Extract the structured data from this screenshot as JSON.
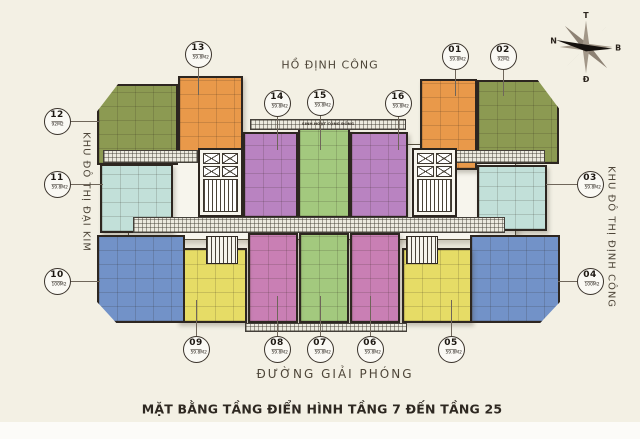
{
  "title": "MẶT BẰNG TẦNG ĐIỂN HÌNH TẦNG 7 ĐẾN TẦNG 25",
  "surroundings": {
    "top": "HỒ ĐỊNH CÔNG",
    "left": "KHU ĐÔ THỊ ĐẠI KIM",
    "right": "KHU ĐÔ THỊ ĐỊNH CÔNG",
    "bottom": "ĐƯỜNG GIẢI PHÓNG"
  },
  "compass": {
    "top": "T",
    "right": "B",
    "bottom": "Đ",
    "left": "N"
  },
  "community_label": "SINH HOẠT CỘNG ĐỒNG",
  "palette": {
    "background": "#f3f0e4",
    "wall": "#2d2620",
    "label_text": "#4e4639",
    "title_text": "#2e2821",
    "orange": "#e9994a",
    "olive": "#8c9a52",
    "teal": "#c2e0d9",
    "blue": "#7292c8",
    "purple": "#b983c1",
    "pink": "#c97fb4",
    "green": "#a3c97e",
    "yellow": "#e6dc66"
  },
  "units": [
    {
      "id": "01",
      "area": "59.8M2",
      "color": "#e9994a",
      "circle": {
        "x": 455,
        "y": 56
      },
      "leader": {
        "x1": 455,
        "y1": 69,
        "x2": 455,
        "y2": 96
      },
      "block": {
        "x": 420,
        "y": 79,
        "w": 57,
        "h": 91,
        "shape": "rect"
      }
    },
    {
      "id": "02",
      "area": "92M2",
      "color": "#8c9a52",
      "circle": {
        "x": 503,
        "y": 56
      },
      "leader": {
        "x1": 503,
        "y1": 69,
        "x2": 503,
        "y2": 96
      },
      "block": {
        "x": 477,
        "y": 80,
        "w": 82,
        "h": 84,
        "shape": "tr-slope"
      }
    },
    {
      "id": "03",
      "area": "59.8M2",
      "color": "#c2e0d9",
      "circle": {
        "x": 590,
        "y": 184
      },
      "leader": {
        "x1": 577,
        "y1": 184,
        "x2": 546,
        "y2": 184
      },
      "block": {
        "x": 477,
        "y": 165,
        "w": 70,
        "h": 66,
        "shape": "rect"
      }
    },
    {
      "id": "04",
      "area": "100M2",
      "color": "#7292c8",
      "circle": {
        "x": 590,
        "y": 281
      },
      "leader": {
        "x1": 577,
        "y1": 281,
        "x2": 558,
        "y2": 281
      },
      "block": {
        "x": 470,
        "y": 235,
        "w": 90,
        "h": 88,
        "shape": "br-slope"
      }
    },
    {
      "id": "05",
      "area": "59.8M2",
      "color": "#e6dc66",
      "circle": {
        "x": 451,
        "y": 349
      },
      "leader": {
        "x1": 451,
        "y1": 300,
        "x2": 451,
        "y2": 336
      },
      "block": {
        "x": 402,
        "y": 248,
        "w": 70,
        "h": 75,
        "shape": "rect"
      }
    },
    {
      "id": "06",
      "area": "59.8M2",
      "color": "#c97fb4",
      "circle": {
        "x": 370,
        "y": 349
      },
      "leader": {
        "x1": 370,
        "y1": 296,
        "x2": 370,
        "y2": 336
      },
      "block": {
        "x": 350,
        "y": 233,
        "w": 50,
        "h": 90,
        "shape": "rect"
      }
    },
    {
      "id": "07",
      "area": "59.8M2",
      "color": "#a3c97e",
      "circle": {
        "x": 320,
        "y": 349
      },
      "leader": {
        "x1": 320,
        "y1": 296,
        "x2": 320,
        "y2": 336
      },
      "block": {
        "x": 299,
        "y": 233,
        "w": 50,
        "h": 90,
        "shape": "rect"
      }
    },
    {
      "id": "08",
      "area": "59.8M2",
      "color": "#c97fb4",
      "circle": {
        "x": 277,
        "y": 349
      },
      "leader": {
        "x1": 277,
        "y1": 296,
        "x2": 277,
        "y2": 336
      },
      "block": {
        "x": 248,
        "y": 233,
        "w": 50,
        "h": 90,
        "shape": "rect"
      }
    },
    {
      "id": "09",
      "area": "59.8M2",
      "color": "#e6dc66",
      "circle": {
        "x": 196,
        "y": 349
      },
      "leader": {
        "x1": 196,
        "y1": 300,
        "x2": 196,
        "y2": 336
      },
      "block": {
        "x": 177,
        "y": 248,
        "w": 70,
        "h": 75,
        "shape": "rect"
      }
    },
    {
      "id": "10",
      "area": "100M2",
      "color": "#7292c8",
      "circle": {
        "x": 57,
        "y": 281
      },
      "leader": {
        "x1": 70,
        "y1": 281,
        "x2": 100,
        "y2": 281
      },
      "block": {
        "x": 97,
        "y": 235,
        "w": 88,
        "h": 88,
        "shape": "bl-slope"
      }
    },
    {
      "id": "11",
      "area": "59.8M2",
      "color": "#c2e0d9",
      "circle": {
        "x": 57,
        "y": 184
      },
      "leader": {
        "x1": 70,
        "y1": 184,
        "x2": 103,
        "y2": 184
      },
      "block": {
        "x": 100,
        "y": 164,
        "w": 73,
        "h": 69,
        "shape": "rect"
      }
    },
    {
      "id": "12",
      "area": "92M2",
      "color": "#8c9a52",
      "circle": {
        "x": 57,
        "y": 121
      },
      "leader": {
        "x1": 70,
        "y1": 121,
        "x2": 100,
        "y2": 121
      },
      "block": {
        "x": 97,
        "y": 84,
        "w": 81,
        "h": 81,
        "shape": "tl-slope"
      }
    },
    {
      "id": "13",
      "area": "59.8M2",
      "color": "#e9994a",
      "circle": {
        "x": 198,
        "y": 54
      },
      "leader": {
        "x1": 198,
        "y1": 67,
        "x2": 198,
        "y2": 95
      },
      "block": {
        "x": 178,
        "y": 76,
        "w": 65,
        "h": 77,
        "shape": "rect"
      }
    },
    {
      "id": "14",
      "area": "59.8M2",
      "color": "#b983c1",
      "circle": {
        "x": 277,
        "y": 103
      },
      "leader": {
        "x1": 277,
        "y1": 116,
        "x2": 277,
        "y2": 150
      },
      "block": {
        "x": 243,
        "y": 132,
        "w": 55,
        "h": 86,
        "shape": "rect"
      }
    },
    {
      "id": "15",
      "area": "59.8M2",
      "color": "#a3c97e",
      "circle": {
        "x": 320,
        "y": 102
      },
      "leader": {
        "x1": 320,
        "y1": 115,
        "x2": 320,
        "y2": 150
      },
      "block": {
        "x": 298,
        "y": 128,
        "w": 52,
        "h": 90,
        "shape": "rect"
      }
    },
    {
      "id": "16",
      "area": "59.8M2",
      "color": "#b983c1",
      "circle": {
        "x": 398,
        "y": 103
      },
      "leader": {
        "x1": 398,
        "y1": 116,
        "x2": 398,
        "y2": 150
      },
      "block": {
        "x": 350,
        "y": 132,
        "w": 58,
        "h": 86,
        "shape": "rect"
      }
    }
  ]
}
